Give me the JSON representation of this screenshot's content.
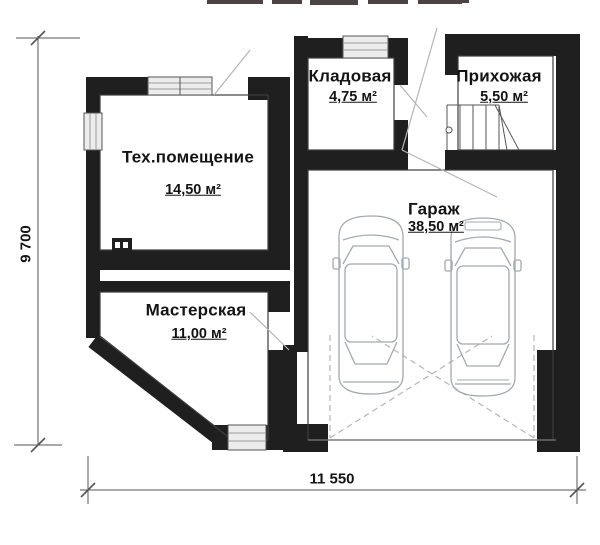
{
  "drawing": {
    "type": "floor-plan",
    "floor_symbols": [
      "stairs",
      "two-cars-top-view",
      "garage-door-swing",
      "boiler-unit",
      "windows",
      "door-swings"
    ]
  },
  "rooms": [
    {
      "key": "tech",
      "name": "Тех.помещение",
      "area": "14,50 м²"
    },
    {
      "key": "kladovaya",
      "name": "Кладовая",
      "area": "4,75 м²"
    },
    {
      "key": "prihozhaya",
      "name": "Прихожая",
      "area": "5,50 м²"
    },
    {
      "key": "garage",
      "name": "Гараж",
      "area": "38,50 м²"
    },
    {
      "key": "masterskaya",
      "name": "Мастерская",
      "area": "11,00 м²"
    }
  ],
  "dimensions": {
    "vertical": "9 700",
    "horizontal": "11 550"
  },
  "colors": {
    "wall": "#1f1f1f",
    "thin_line": "#3d3d3d",
    "dim_line": "#555555",
    "swing": "#b5b5b5",
    "car": "#a3a9ae",
    "window_fill": "#ececec"
  }
}
